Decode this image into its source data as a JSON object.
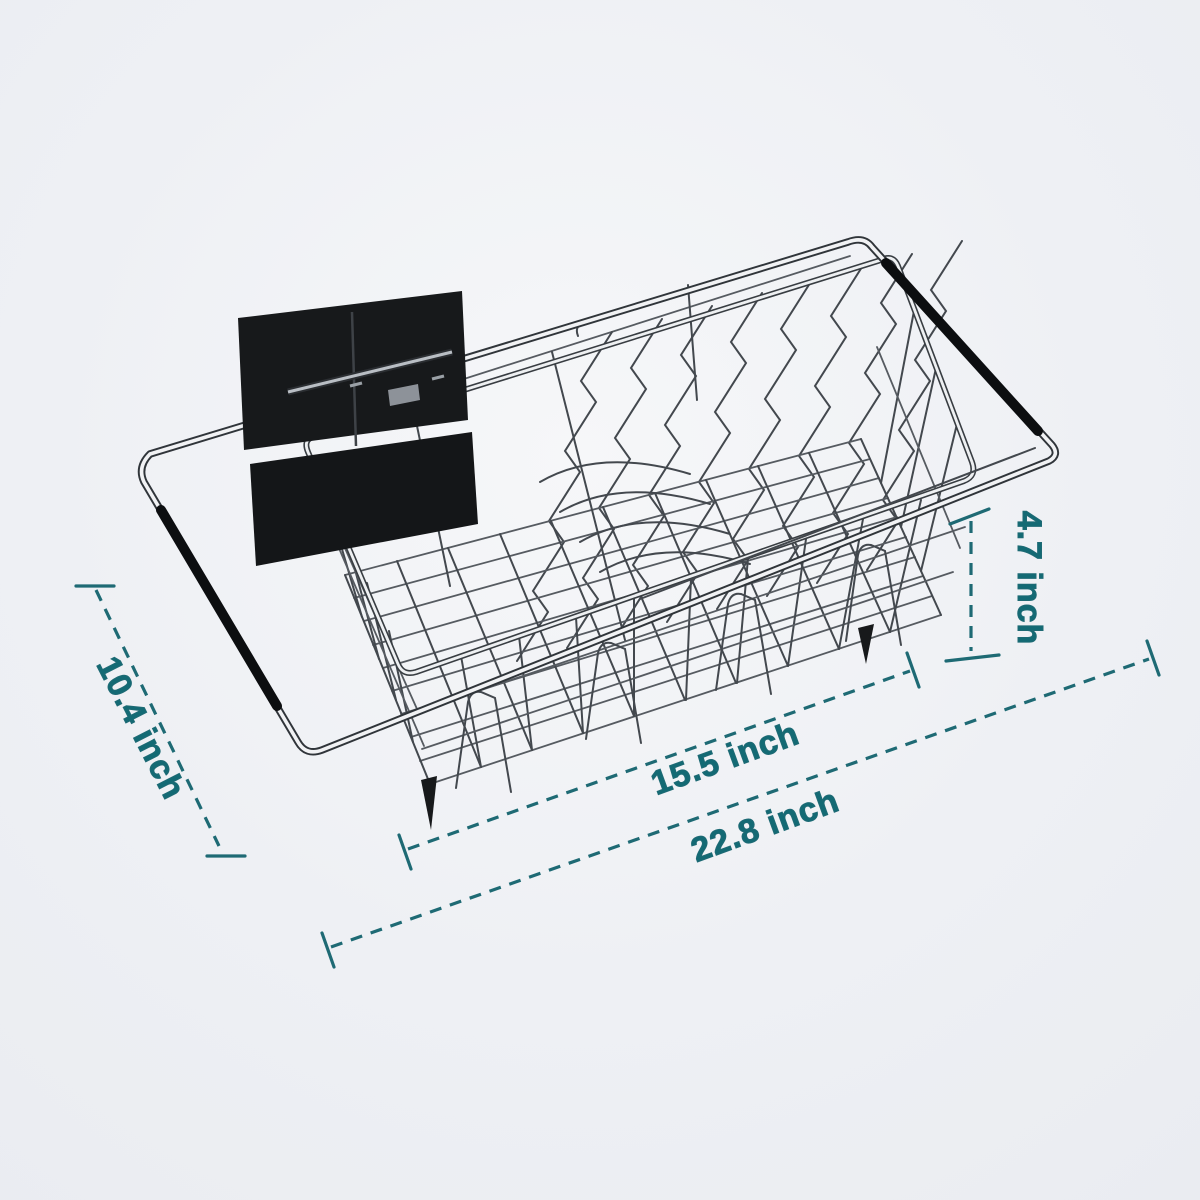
{
  "image": {
    "type": "product-dimension-diagram",
    "product": "Expandable stainless steel over-sink dish drying rack with utensil holder",
    "background_color": "#edeef3"
  },
  "dimensions": {
    "width": {
      "label": "10.4 inch",
      "value": 10.4,
      "unit": "inch"
    },
    "basket_length": {
      "label": "15.5 inch",
      "value": 15.5,
      "unit": "inch"
    },
    "extended_length": {
      "label": "22.8 inch",
      "value": 22.8,
      "unit": "inch"
    },
    "depth": {
      "label": "4.7 inch",
      "value": 4.7,
      "unit": "inch"
    }
  },
  "style": {
    "annotation_text_color": "#136a74",
    "annotation_line_color": "#1e6a74",
    "wire_color": "#43484e",
    "tube_dark_color": "#30353a",
    "tube_light_color": "#f1f2f4",
    "grip_color": "#0c0e10",
    "caddy_color": "#17191b"
  }
}
